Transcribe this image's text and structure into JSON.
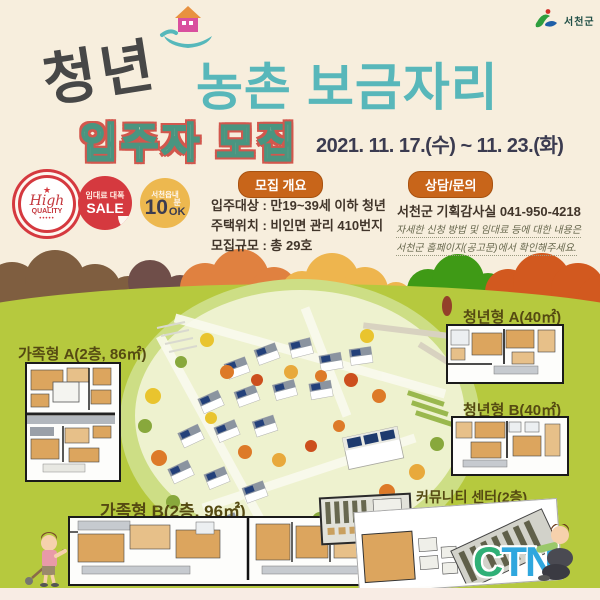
{
  "org": {
    "name": "서천군"
  },
  "header": {
    "title_left": "청년",
    "title_right": "농촌 보금자리",
    "subtitle": "입주자 모집",
    "date_range": "2021. 11. 17.(수) ~ 11. 23.(화)"
  },
  "badges": {
    "quality": {
      "line1": "High",
      "line2": "QUALITY",
      "dots": "•••••",
      "star": "★"
    },
    "sale": {
      "line1": "임대료 대폭",
      "line2": "SALE"
    },
    "ten_min": {
      "line1": "서천읍내",
      "number": "10",
      "unit": "분",
      "ok": "OK"
    }
  },
  "recruit_overview": {
    "heading": "모집 개요",
    "items": [
      {
        "text": "입주대상 : 만19~39세 이하 청년"
      },
      {
        "text": "주택위치 : 비인면 관리 410번지"
      },
      {
        "text": "모집규모 : 총  29호"
      }
    ]
  },
  "contact": {
    "heading": "상담/문의",
    "office": "서천군 기획감사실  041-950-4218",
    "note1": "자세한 신청 방법 및 임대료 등에 대한 내용은",
    "note2": "서천군 홈페이지(공고문)에서 확인해주세요."
  },
  "plans": {
    "family_a": "가족형 A(2층, 86㎡)",
    "youth_a": "청년형 A(40㎡)",
    "youth_b": "청년형 B(40㎡)",
    "family_b": "가족형 B(2층, 96㎡)",
    "community": "커뮤니티 센터(2층)"
  },
  "footer": {
    "logo_c": "C",
    "logo_tn": "TN"
  }
}
